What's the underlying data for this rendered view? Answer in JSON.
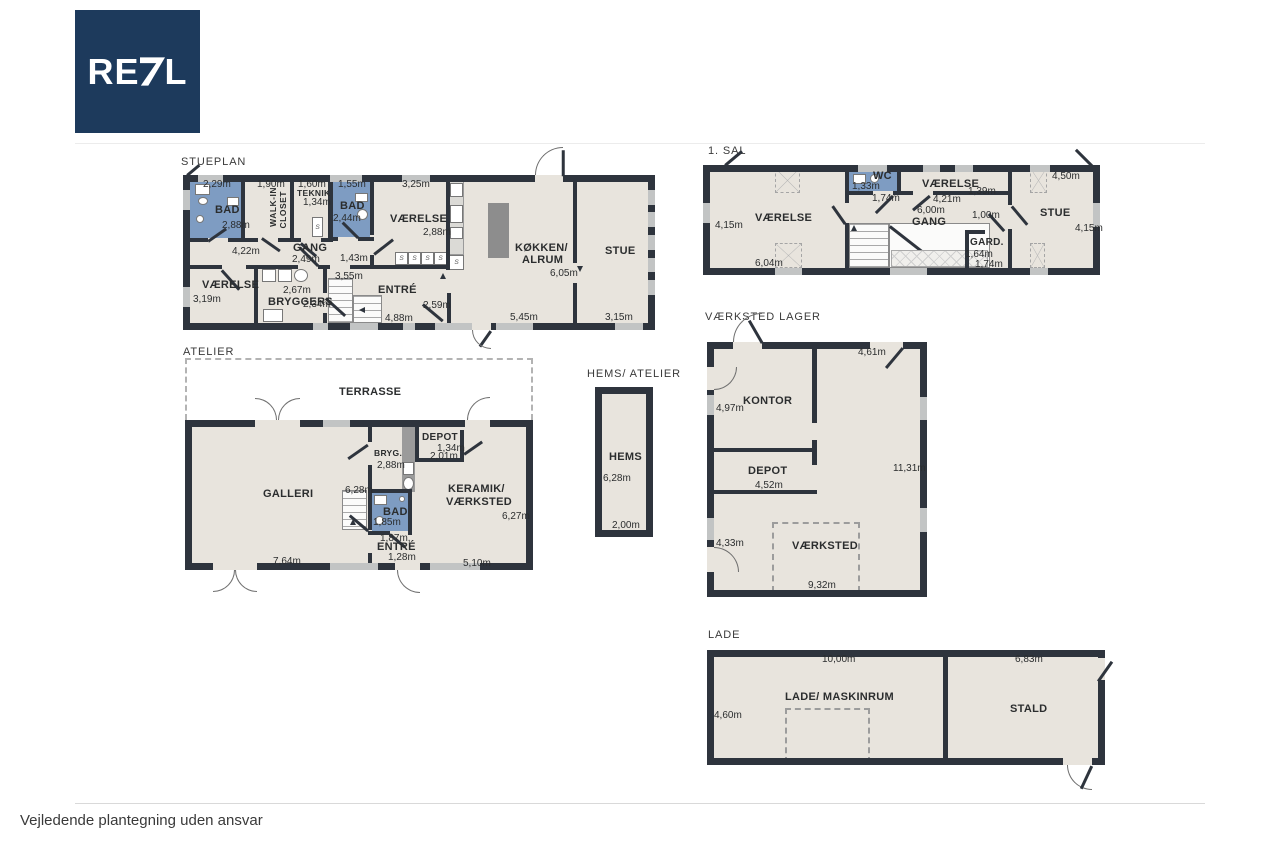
{
  "logo": {
    "prefix": "RE",
    "suffix": "L"
  },
  "footer": {
    "disclaimer": "Vejledende plantegning uden ansvar"
  },
  "colors": {
    "wall": "#2e343d",
    "floor": "#e8e4dd",
    "wet": "#7e9cc2",
    "island": "#8d8d8d",
    "counter": "#dbdad6",
    "logo_bg": "#1d3a5c"
  },
  "plans": {
    "stueplan": {
      "title": "STUEPLAN",
      "labels": {
        "bad1_name": "BAD",
        "bad1_width": "2,29m",
        "bad1_depth": "2,88m",
        "walkin_line1": "WALK-IN",
        "walkin_line2": "CLOSET",
        "walkin_width": "1,90m",
        "teknik_name": "TEKNIK",
        "teknik_width": "1,60m",
        "teknik_depth": "1,34m",
        "bad2_name": "BAD",
        "bad2_width": "1,55m",
        "bad2_depth": "2,44m",
        "vaerelse_top_name": "VÆRELSE",
        "vaerelse_top_width": "3,25m",
        "vaerelse_top_depth": "2,88m",
        "gang_name": "GANG",
        "gang_width": "2,49m",
        "gang_span": "4,22m",
        "gang_door": "1,43m",
        "vaerelse_left_name": "VÆRELSE",
        "vaerelse_left_depth": "3,19m",
        "bryggers_name": "BRYGGERS",
        "bryggers_width": "2,67m",
        "bryggers_depth": "2,34m",
        "entre_name": "ENTRÉ",
        "entre_depth": "3,55m",
        "entre_width": "4,88m",
        "entre_door": "2,59m",
        "koekken_line1": "KØKKEN/",
        "koekken_line2": "ALRUM",
        "koekken_depth": "6,05m",
        "koekken_width": "5,45m",
        "stue_name": "STUE",
        "stue_width": "3,15m",
        "closet": "S"
      }
    },
    "sal1": {
      "title": "1. SAL",
      "labels": {
        "vaerelse_left_name": "VÆRELSE",
        "vaerelse_left_depth": "4,15m",
        "vaerelse_left_width": "6,04m",
        "wc_name": "WC",
        "wc_width": "1,33m",
        "wc_depth": "1,74m",
        "vaerelse_right_name": "VÆRELSE",
        "vaerelse_right_width": "4,21m",
        "vaerelse_right_depth": "1,39m",
        "gang_name": "GANG",
        "gang_width": "6,00m",
        "gang_door": "1,00m",
        "gard_name": "GARD.",
        "gard_width": "1,64m",
        "gard_depth": "1,74m",
        "stue_name": "STUE",
        "stue_width": "4,50m",
        "stue_depth": "4,15m"
      }
    },
    "atelier": {
      "title": "ATELIER",
      "labels": {
        "terrasse_name": "TERRASSE",
        "galleri_name": "GALLERI",
        "galleri_width": "7,64m",
        "galleri_depth": "6,28m",
        "bryg_name": "BRYG.",
        "bryg_depth": "2,88m",
        "depot_name": "DEPOT",
        "depot_width": "1,34m",
        "depot_depth": "2,01m",
        "bad_name": "BAD",
        "bad_width": "1,85m",
        "entre_name": "ENTRÉ",
        "entre_dim1": "1,87m,",
        "entre_width": "1,28m",
        "keramik_line1": "KERAMIK/",
        "keramik_line2": "VÆRKSTED",
        "keramik_depth": "6,27m",
        "keramik_width": "5,10m"
      }
    },
    "hems": {
      "title": "HEMS/ ATELIER",
      "labels": {
        "hems_name": "HEMS",
        "hems_depth": "6,28m",
        "hems_width": "2,00m"
      }
    },
    "vaerksted": {
      "title": "VÆRKSTED LAGER",
      "labels": {
        "top_width": "4,61m",
        "kontor_name": "KONTOR",
        "kontor_depth": "4,97m",
        "depot_name": "DEPOT",
        "depot_width": "4,52m",
        "right_depth": "11,31m",
        "left_dim": "4,33m",
        "vaerksted_name": "VÆRKSTED",
        "vaerksted_width": "9,32m"
      }
    },
    "lade": {
      "title": "LADE",
      "labels": {
        "lade_width": "10,00m",
        "lade_depth": "4,60m",
        "lade_name": "LADE/ MASKINRUM",
        "stald_name": "STALD",
        "stald_width": "6,83m"
      }
    }
  }
}
